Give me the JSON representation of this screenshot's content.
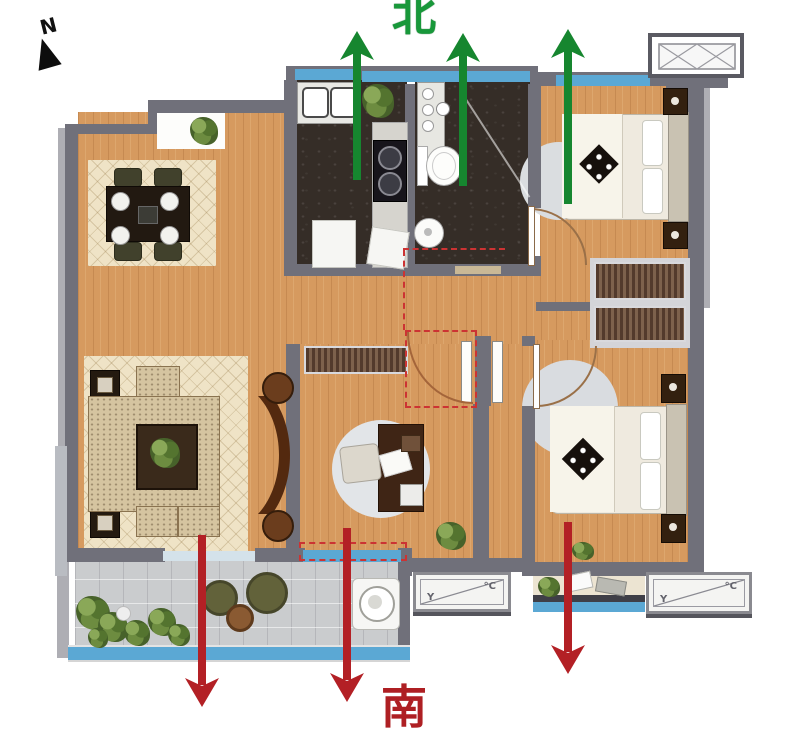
{
  "compass": {
    "label": "N"
  },
  "orientation": {
    "north_label": "北",
    "south_label": "南",
    "north_arrow_count": 3,
    "south_arrow_count": 3
  },
  "ac_platform": {
    "glyph_left": "Y",
    "glyph_right": "°C"
  },
  "colors": {
    "north-green": "#18983a",
    "south-red": "#ae1f23",
    "arrow-green": "#16862f",
    "arrow-red": "#b32025",
    "wall": "#70707a",
    "wall-light": "#aeaeb4",
    "wood": "#d69a5f",
    "window-blue": "#5ba8d4",
    "dark-room": "#352d27",
    "rug-cream": "#efe3c6",
    "balcony-tile": "#caccce",
    "dashed-red": "#cc3333"
  }
}
